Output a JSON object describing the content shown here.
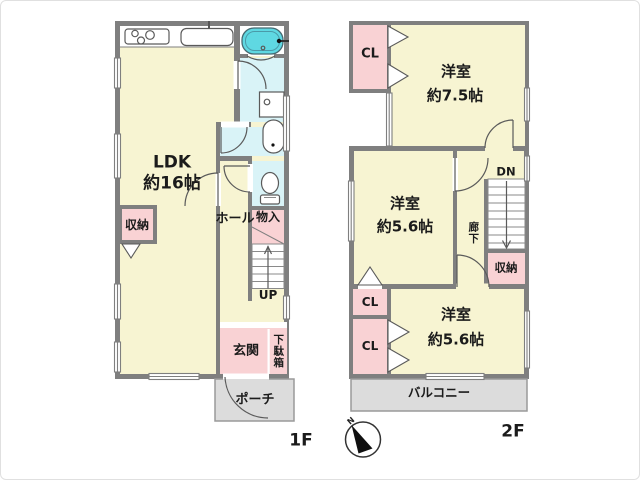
{
  "colors": {
    "wall": "#7f7f7f",
    "room_cream": "#f7f4d2",
    "closet_pink": "#f9d2d4",
    "water_cyan": "#d9f3f7",
    "tub_cyan": "#5fd8e2",
    "outdoor_gray": "#dcdcdc",
    "text": "#1b1b1b"
  },
  "floor1": {
    "label": "1F",
    "ldk": {
      "name": "LDK",
      "size": "約16帖"
    },
    "storage": "収納",
    "hall": "ホール",
    "closet": "物入",
    "stairs": "UP",
    "entrance": "玄関",
    "shoe_cabinet": "下駄箱",
    "porch": "ポーチ"
  },
  "floor2": {
    "label": "2F",
    "closet_top": "CL",
    "room_75": {
      "name": "洋室",
      "size": "約7.5帖"
    },
    "room_56_mid": {
      "name": "洋室",
      "size": "約5.6帖"
    },
    "corridor": "廊下",
    "stairs": "DN",
    "storage": "収納",
    "closet_mid": "CL",
    "closet_low": "CL",
    "room_56_low": {
      "name": "洋室",
      "size": "約5.6帖"
    },
    "balcony": "バルコニー"
  },
  "compass": {
    "north": "N"
  }
}
